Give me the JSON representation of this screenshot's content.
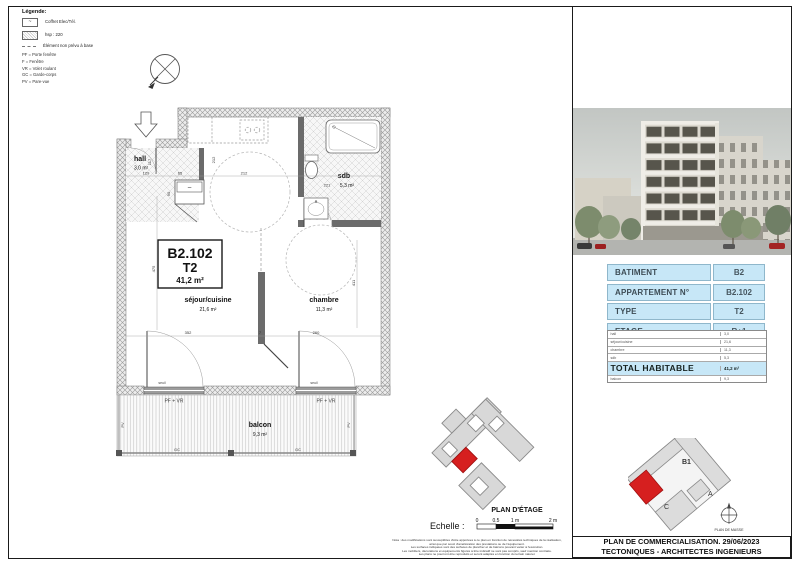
{
  "legend": {
    "title": "Légende:",
    "items": [
      {
        "symbol": "~",
        "label": "Coffret Elec/Tél."
      },
      {
        "symbol": "",
        "label": "hsp : 220"
      },
      {
        "symbol": "",
        "label": "Élément non prévu à base"
      }
    ],
    "abbreviations": [
      "PF = Porte fenêtre",
      "F = Fenêtre",
      "VR = Volet roulant",
      "GC = Garde-corps",
      "PV = Pare-vue"
    ]
  },
  "plan": {
    "unit": {
      "id": "B2.102",
      "type": "T2",
      "area": "41,2 m²"
    },
    "rooms": {
      "hall": {
        "name": "hall",
        "area": "3,0 m²"
      },
      "sejour": {
        "name": "séjour/cuisine",
        "area": "21,6 m²"
      },
      "chambre": {
        "name": "chambre",
        "area": "11,3 m²"
      },
      "sdb": {
        "name": "sdb",
        "area": "5,3 m²"
      },
      "balcon": {
        "name": "balcon",
        "area": "9,3 m²"
      }
    },
    "annotations": {
      "pf_vr": "PF + VR",
      "seuil": "seuil",
      "gc": "GC",
      "pv": "PV",
      "coffret": "~"
    },
    "dimensions": {
      "d129": "129",
      "d117": "117",
      "d65": "65",
      "d212": "212",
      "d212b": "212",
      "d221": "221",
      "d475": "475",
      "d352": "352",
      "d7": "7",
      "d260": "260",
      "d411": "411",
      "d90": "90"
    }
  },
  "key_plans": {
    "etage": {
      "caption": "PLAN D'ÉTAGE"
    },
    "masse": {
      "caption": "PLAN DE MASSE",
      "buildings": {
        "b1": "B1",
        "a": "A",
        "c": "C"
      }
    }
  },
  "scale_bar": {
    "label": "Echelle :",
    "ticks": [
      "0",
      "0.5",
      "1 m",
      "2 m"
    ]
  },
  "info_table": {
    "rows": [
      {
        "label": "BATIMENT",
        "value": "B2"
      },
      {
        "label": "APPARTEMENT N°",
        "value": "B2.102"
      },
      {
        "label": "TYPE",
        "value": "T2"
      },
      {
        "label": "ETAGE",
        "value": "R+1"
      }
    ]
  },
  "area_table": {
    "rows": [
      {
        "label": "hall",
        "value": "3,0"
      },
      {
        "label": "séjour/cuisine",
        "value": "21,6"
      },
      {
        "label": "chambre",
        "value": "11,3"
      },
      {
        "label": "sdb",
        "value": "5,3"
      }
    ],
    "total": {
      "label": "TOTAL HABITABLE",
      "value": "41,2 m²"
    },
    "extra": {
      "label": "balcon",
      "value": "9,3"
    }
  },
  "title_block": {
    "line1": "PLAN DE COMMERCIALISATION. 29/06/2023",
    "line2": "TECTONIQUES - ARCHITECTES INGENIEURS"
  },
  "disclaimer": {
    "lines": [
      "Nota : des modifications sont susceptibles d'être apportées à ce plan en fonction de nécessités techniques de la réalisation,",
      "ainsi que par souci d'amélioration des prestations ou de l'équipement.",
      "Les surfaces indiquées sont des surfaces de plancher et de balcons pouvant varier à l'exécution.",
      "Les mobiliers, décorations et équipements figurés à titre indicatif ne sont pas compris, sauf mention contraire.",
      "Les plans ne pourront être reproduits et seront adaptés en fonction du terrain naturel."
    ]
  },
  "colors": {
    "table_blue": "#c7e7f7",
    "highlight_red": "#d61f1f",
    "keyplan_gray": "#d8d8d8"
  }
}
